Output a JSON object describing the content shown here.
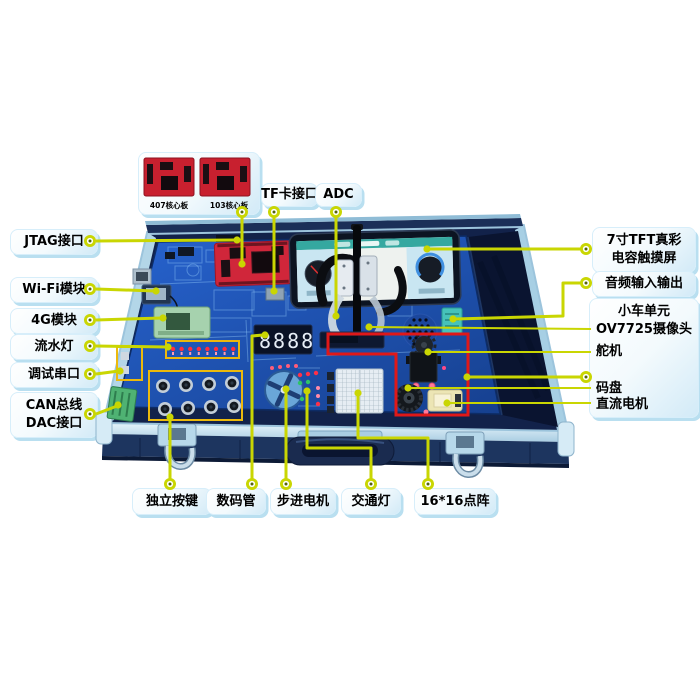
{
  "colors": {
    "callout_line": "#c9d602",
    "highlight_box_red": "#e01818",
    "component_box_yellow": "#ecb90c",
    "label_bg": "#d2eaf7",
    "pcb_blue": "#1f55b8",
    "case_aluminum": "#b7d8ea"
  },
  "core_panel": {
    "boards": [
      {
        "label": "407核心板"
      },
      {
        "label": "103核心板"
      }
    ]
  },
  "labels": {
    "tf_card": "TF卡接口",
    "adc": "ADC",
    "jtag": "JTAG接口",
    "wifi": "Wi-Fi模块",
    "module_4g": "4G模块",
    "flow_led": "流水灯",
    "debug_uart": "调试串口",
    "can_bus": "CAN总线",
    "dac": "DAC接口",
    "tft_line1": "7寸TFT真彩",
    "tft_line2": "电容触摸屏",
    "audio_io": "音频输入输出",
    "car_unit": "小车单元",
    "camera": "OV7725摄像头",
    "servo": "舵机",
    "encoder": "码盘",
    "dc_motor": "直流电机",
    "keys": "独立按键",
    "segment_display": "数码管",
    "stepper": "步进电机",
    "traffic_light": "交通灯",
    "dot_matrix": "16*16点阵"
  },
  "board": {
    "segment_display_value": "8888"
  }
}
